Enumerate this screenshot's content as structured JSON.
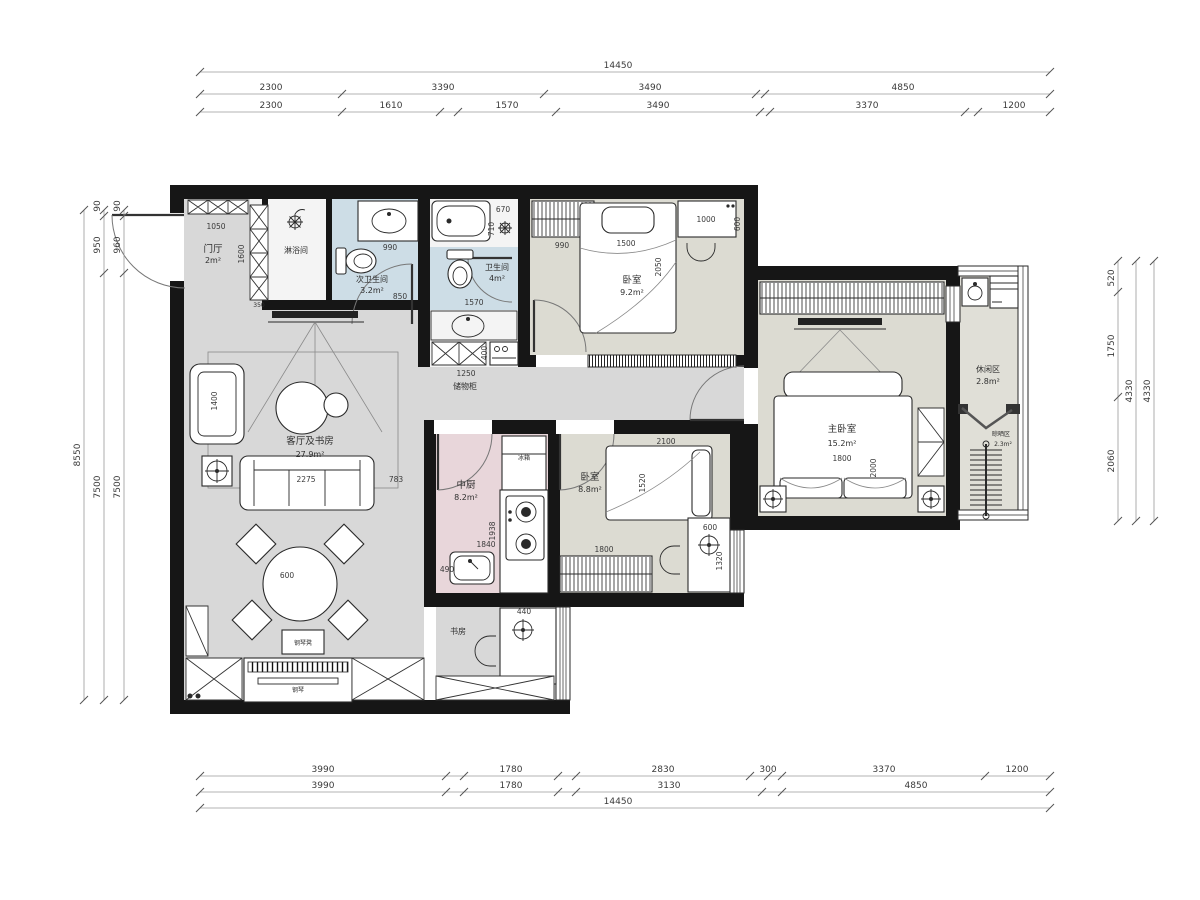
{
  "drawing_type": "apartment-floor-plan",
  "colors": {
    "wall": "#161616",
    "floor_gray": "#d8d8d8",
    "floor_beige": "#dcdbd2",
    "floor_pink": "#e8d6da",
    "floor_blue": "#cddde6",
    "floor_white": "#f4f4f4",
    "floor_balcony": "#e0dfd7"
  },
  "rooms": {
    "entry": {
      "name": "门厅",
      "area": "2m²"
    },
    "shower": {
      "name": "淋浴间",
      "area": ""
    },
    "bath2": {
      "name": "次卫生间",
      "area": "3.2m²"
    },
    "bath1": {
      "name": "卫生间",
      "area": "4m²"
    },
    "bedroom1": {
      "name": "卧室",
      "area": "9.2m²"
    },
    "master": {
      "name": "主卧室",
      "area": "15.2m²"
    },
    "bedroom2": {
      "name": "卧室",
      "area": "8.8m²"
    },
    "kitchen": {
      "name": "中厨",
      "area": "8.2m²"
    },
    "living": {
      "name": "客厅及书房",
      "area": "27.9m²"
    },
    "study": {
      "name": "书房",
      "area": ""
    },
    "leisure": {
      "name": "休闲区",
      "area": "2.8m²"
    },
    "drying": {
      "name": "晾晒区",
      "area": "2.3m²"
    },
    "storage": {
      "name": "储物柜",
      "area": ""
    }
  },
  "labels": {
    "fridge": "冰箱",
    "piano": "钢琴",
    "piano_stool": "钢琴凳"
  },
  "dims": {
    "top": {
      "row1": [
        "14450"
      ],
      "row2": [
        "2300",
        "3390",
        "3490",
        "4850"
      ],
      "row3": [
        "2300",
        "1610",
        "1570",
        "3490",
        "3370",
        "1200"
      ]
    },
    "bottom": {
      "row1": [
        "3990",
        "1780",
        "2830",
        "300",
        "3370",
        "1200"
      ],
      "row2": [
        "3990",
        "1780",
        "3130",
        "4850"
      ],
      "row3": [
        "14450"
      ]
    },
    "left": {
      "col1": [
        "8550"
      ],
      "col2": [
        "90",
        "950",
        "7500"
      ],
      "col3": [
        "90",
        "960",
        "7500"
      ]
    },
    "right": {
      "col1": [
        "520",
        "1750",
        "2060"
      ],
      "col2": [
        "4330"
      ],
      "col3": [
        "4330"
      ]
    },
    "inner": {
      "entry_w": "1050",
      "entry_h": "1600",
      "closet_d": "350",
      "bath2_counter": "990",
      "bath2_door": "850",
      "tub_l": "670",
      "tub_w": "710",
      "bath1_w": "1570",
      "storage_w": "1250",
      "storage_d": "400",
      "b1_wardrobe": "990",
      "b1_bed_w": "1500",
      "b1_bed_l": "2050",
      "b1_desk_l": "1000",
      "b1_desk_w": "600",
      "m_bed_w": "1800",
      "m_bed_l": "2000",
      "sofa_l": "2275",
      "sofa_gap": "783",
      "chaise_l": "1400",
      "dining_d": "600",
      "k_w": "1840",
      "k_l": "1938",
      "k_sink": "490",
      "study_d": "440",
      "b2_bed_l": "2100",
      "b2_bed_w": "1520",
      "b2_wardrobe": "1800",
      "b2_desk_w": "600",
      "b2_desk_l": "1320"
    }
  }
}
